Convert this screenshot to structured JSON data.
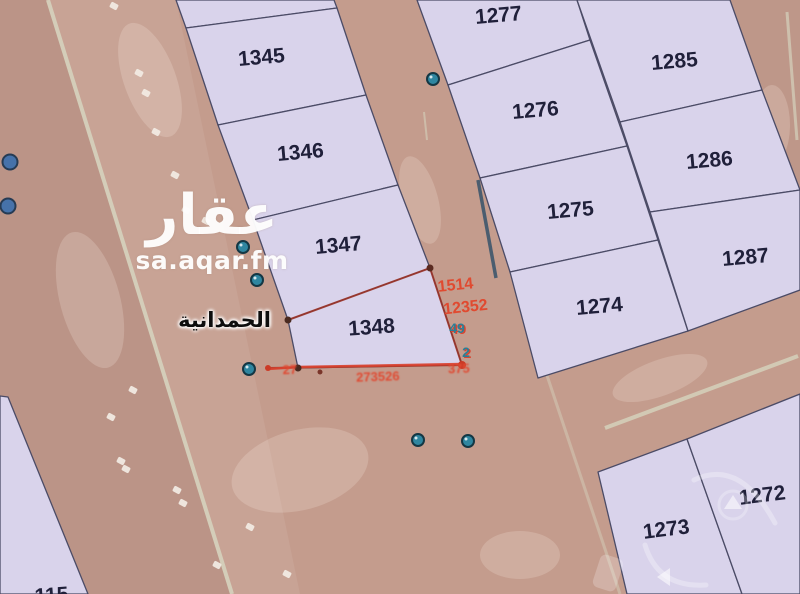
{
  "source_watermark": {
    "logo": "عقار",
    "site": "sa.aqar.fm"
  },
  "district_label": "الحمدانية",
  "selected_parcel_label": "1348",
  "map": {
    "width": 800,
    "height": 594,
    "colors": {
      "road": "#c49c8d",
      "parcel_fill": "#d9d3eb",
      "parcel_stroke": "#4b4b66",
      "selected_stroke": "#a03325",
      "label": "#20203a",
      "red": "#d8402d",
      "red_text": "#e04a30",
      "teal_text": "#2c7e95",
      "marker_fill": "#2f86a0",
      "marker_stroke": "#143744",
      "blue_blob": "#3a6fae",
      "stripe": "#d9dcc5",
      "car": "#f2ece4"
    },
    "parcels": [
      {
        "label": "",
        "points": "176,0 334,0 337,8 186,28",
        "lx": 0,
        "ly": 0,
        "rot": 0,
        "selected": false
      },
      {
        "label": "1345",
        "points": "186,28 337,8 366,95 218,125",
        "lx": 262,
        "ly": 64,
        "rot": -5,
        "selected": false
      },
      {
        "label": "1346",
        "points": "218,125 366,95 398,185 253,220",
        "lx": 301,
        "ly": 159,
        "rot": -5,
        "selected": false
      },
      {
        "label": "1347",
        "points": "253,220 398,185 430,268 288,320",
        "lx": 339,
        "ly": 252,
        "rot": -5,
        "selected": false
      },
      {
        "label": "1348",
        "points": "288,320 430,268 462,365 298,368",
        "lx": 372,
        "ly": 334,
        "rot": -4,
        "selected": true
      },
      {
        "label": "1277",
        "points": "417,0 577,0 590,40 448,85",
        "lx": 499,
        "ly": 22,
        "rot": -5,
        "selected": false
      },
      {
        "label": "1276",
        "points": "448,85 590,40 627,146 480,178",
        "lx": 536,
        "ly": 117,
        "rot": -5,
        "selected": false
      },
      {
        "label": "1275",
        "points": "480,178 627,146 658,240 510,272",
        "lx": 571,
        "ly": 217,
        "rot": -5,
        "selected": false
      },
      {
        "label": "1274",
        "points": "510,272 658,240 688,331 538,378",
        "lx": 600,
        "ly": 313,
        "rot": -5,
        "selected": false
      },
      {
        "label": "1285",
        "points": "577,0 730,0 762,90 620,122",
        "lx": 675,
        "ly": 68,
        "rot": -5,
        "selected": false
      },
      {
        "label": "1286",
        "points": "620,122 762,90 800,190 650,212",
        "lx": 710,
        "ly": 167,
        "rot": -5,
        "selected": false
      },
      {
        "label": "1287",
        "points": "650,212 800,190 800,290 688,331",
        "lx": 746,
        "ly": 264,
        "rot": -5,
        "selected": false
      },
      {
        "label": "1273",
        "points": "598,472 687,439 742,594 627,594",
        "lx": 667,
        "ly": 536,
        "rot": -7,
        "selected": false
      },
      {
        "label": "1272",
        "points": "687,439 800,394 800,594 742,594",
        "lx": 763,
        "ly": 502,
        "rot": -7,
        "selected": false
      },
      {
        "label": "115",
        "points": "0,396 8,397 88,594 0,594",
        "lx": 52,
        "ly": 602,
        "rot": -4,
        "selected": false
      }
    ],
    "bands": [
      {
        "points": "0,0 46,0 230,594 0,594",
        "fill": "rgba(100,80,75,0.09)"
      },
      {
        "points": "46,0 176,0 300,594 230,594",
        "fill": "rgba(255,255,255,0.07)"
      },
      {
        "points": "730,0 800,0 800,190",
        "fill": "rgba(110,88,80,0.06)"
      }
    ],
    "road_stripes": [
      {
        "x1": 48,
        "y1": 0,
        "x2": 232,
        "y2": 594,
        "w": 4,
        "o": 0.75
      },
      {
        "x1": 455,
        "y1": 100,
        "x2": 620,
        "y2": 594,
        "w": 3,
        "o": 0.4
      },
      {
        "x1": 605,
        "y1": 428,
        "x2": 798,
        "y2": 356,
        "w": 4,
        "o": 0.7
      },
      {
        "x1": 787,
        "y1": 12,
        "x2": 797,
        "y2": 140,
        "w": 3,
        "o": 0.6
      },
      {
        "x1": 424,
        "y1": 112,
        "x2": 427,
        "y2": 140,
        "w": 2,
        "o": 0.5
      }
    ],
    "patches": [
      [
        150,
        80,
        26,
        60,
        -20
      ],
      [
        238,
        28,
        16,
        30,
        -20
      ],
      [
        700,
        35,
        45,
        22,
        15
      ],
      [
        772,
        125,
        18,
        40,
        0
      ],
      [
        300,
        470,
        70,
        40,
        -15
      ],
      [
        520,
        555,
        40,
        24,
        0
      ],
      [
        660,
        378,
        50,
        18,
        -20
      ],
      [
        90,
        300,
        30,
        70,
        -15
      ],
      [
        420,
        200,
        18,
        45,
        -15
      ]
    ],
    "cars": [
      [
        114,
        6
      ],
      [
        139,
        73
      ],
      [
        146,
        93
      ],
      [
        156,
        132
      ],
      [
        175,
        175
      ],
      [
        186,
        210
      ],
      [
        206,
        221
      ],
      [
        133,
        390
      ],
      [
        111,
        417
      ],
      [
        121,
        461
      ],
      [
        126,
        469
      ],
      [
        177,
        490
      ],
      [
        183,
        503
      ],
      [
        217,
        565
      ],
      [
        250,
        527
      ],
      [
        287,
        574
      ]
    ],
    "markers": [
      [
        243,
        247
      ],
      [
        257,
        280
      ],
      [
        433,
        79
      ],
      [
        418,
        440
      ],
      [
        468,
        441
      ],
      [
        249,
        369
      ]
    ],
    "blue_blobs": [
      [
        10,
        162
      ],
      [
        8,
        206
      ]
    ],
    "selected_overlay": {
      "edge_path": "M288,320 L430,268 L462,365 L268,368",
      "bottom_line": "M268,369 L298,367 L462,364",
      "dots": [
        [
          288,
          320,
          3.5,
          "#4a2a20"
        ],
        [
          430,
          268,
          3.5,
          "#5a2a20"
        ],
        [
          462,
          365,
          4,
          "#cc3a26"
        ],
        [
          298,
          368,
          3.5,
          "#4a2a20"
        ],
        [
          320,
          372,
          2.5,
          "#7a352a"
        ],
        [
          268,
          368,
          3,
          "#cc3a26"
        ]
      ],
      "edge_accent": {
        "x1": 478,
        "y1": 180,
        "x2": 496,
        "y2": 278
      }
    },
    "red_annotations": [
      {
        "text": "1514",
        "x": 456,
        "y": 290,
        "size": 16,
        "rot": -6,
        "teal": false,
        "blur": false
      },
      {
        "text": "12352",
        "x": 466,
        "y": 312,
        "size": 16,
        "rot": -6,
        "teal": false,
        "blur": false
      },
      {
        "text": "49",
        "x": 457,
        "y": 333,
        "size": 14,
        "rot": 0,
        "teal": true,
        "blur": false
      },
      {
        "text": "2",
        "x": 466,
        "y": 357,
        "size": 14,
        "rot": 0,
        "teal": true,
        "blur": false
      },
      {
        "text": "27",
        "x": 290,
        "y": 374,
        "size": 13,
        "rot": -2,
        "teal": false,
        "blur": true
      },
      {
        "text": "273526",
        "x": 378,
        "y": 381,
        "size": 13,
        "rot": -2,
        "teal": false,
        "blur": true
      },
      {
        "text": "375",
        "x": 459,
        "y": 373,
        "size": 13,
        "rot": -2,
        "teal": false,
        "blur": true
      }
    ],
    "nav_arrows": {
      "up_chevron": "733,495 724,509 742,509",
      "left_chevron": "657,577 670,568 670,586",
      "circle": [
        733,
        505,
        14
      ],
      "arc1": "M694,480 Q740,458 775,523",
      "arc2": "M645,545 Q658,588 706,585",
      "ghost_rect": [
        596,
        556,
        24,
        34,
        18
      ]
    }
  }
}
